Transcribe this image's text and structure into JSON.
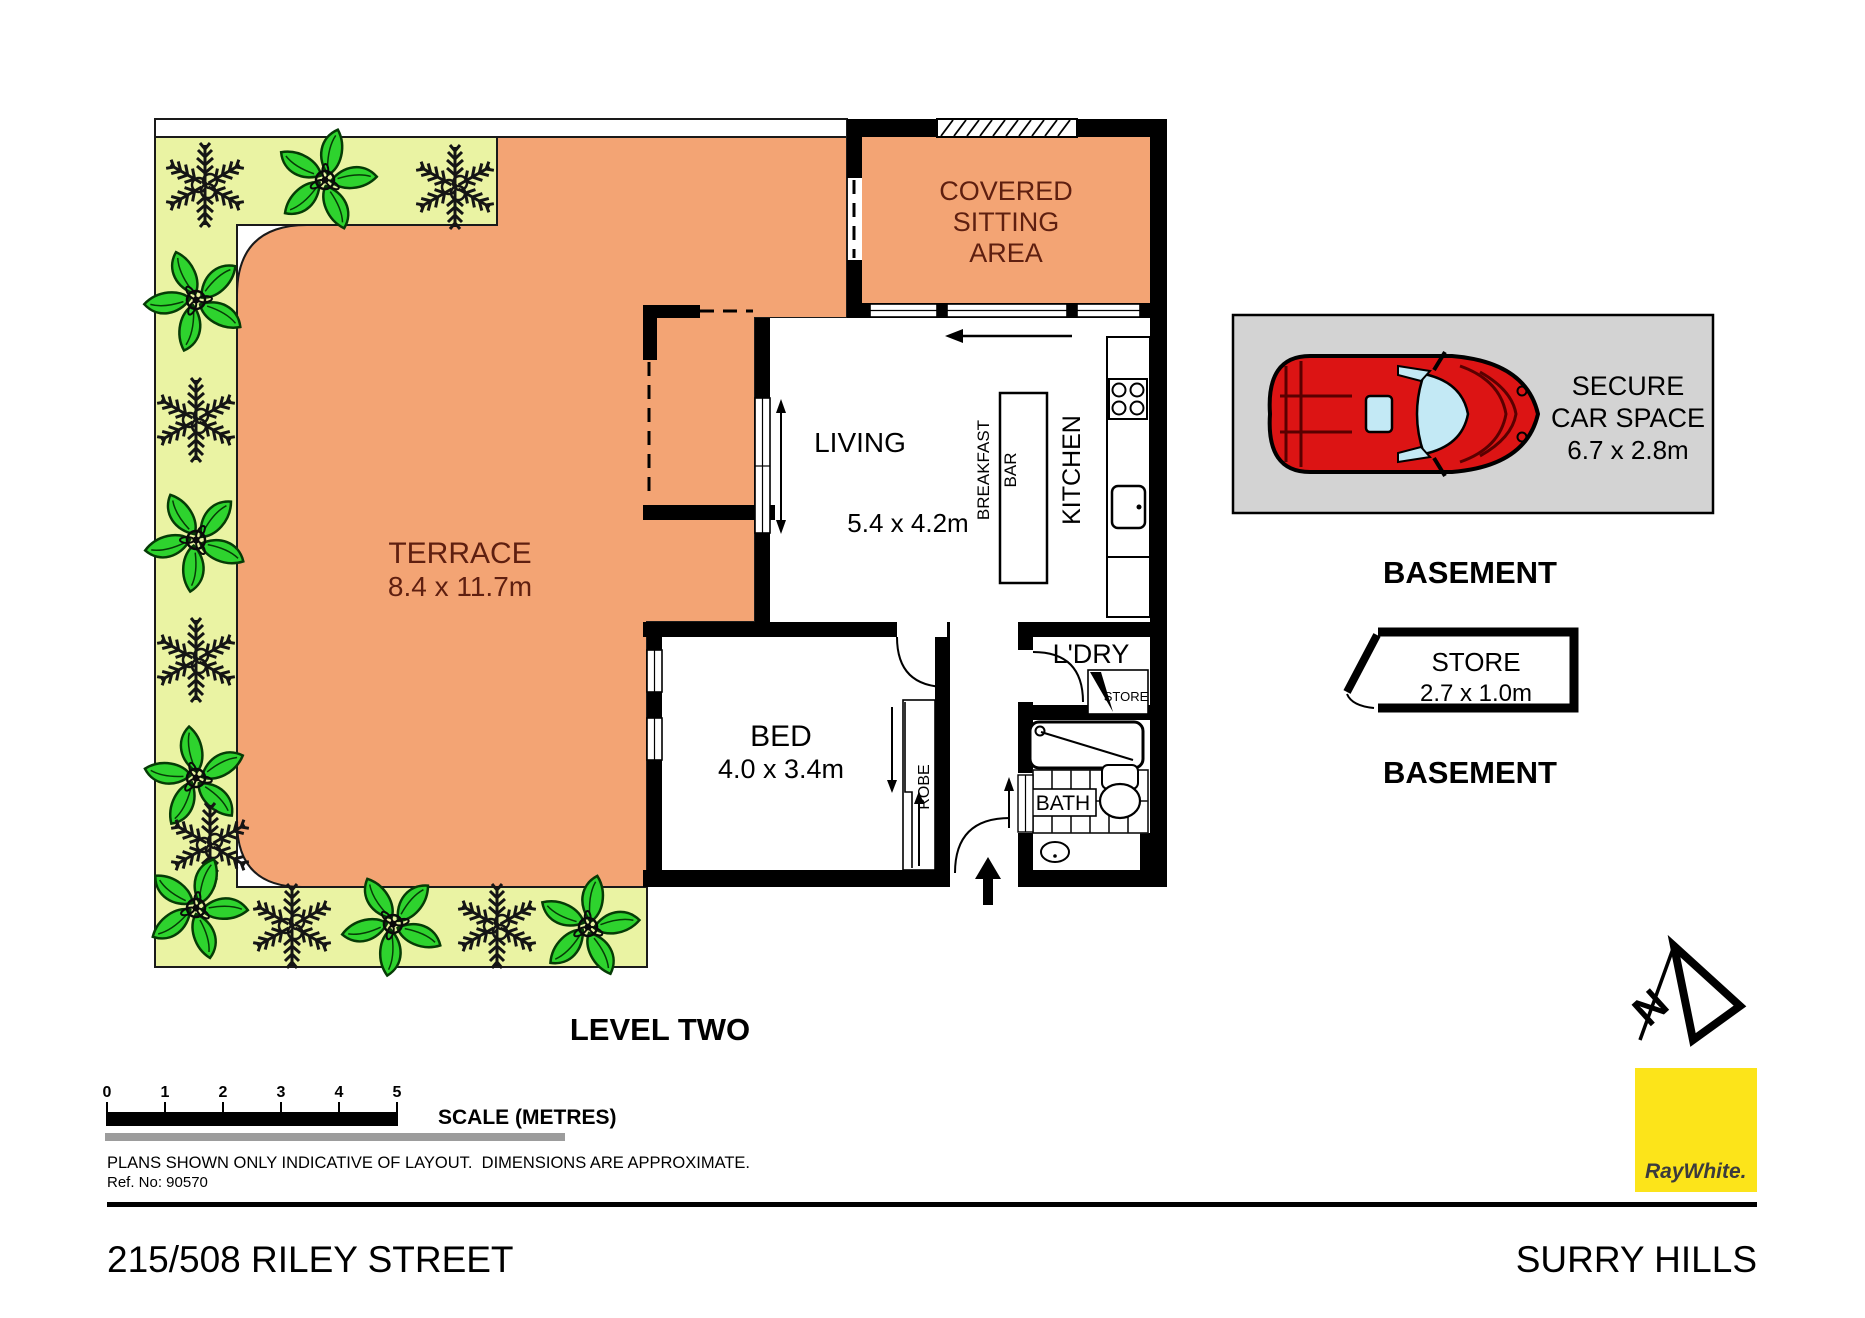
{
  "plan": {
    "level_label": "LEVEL TWO",
    "rooms": {
      "terrace": {
        "label": "TERRACE",
        "dims": "8.4 x 11.7m"
      },
      "covered_sitting": {
        "lines": [
          "COVERED",
          "SITTING",
          "AREA"
        ]
      },
      "living": {
        "label": "LIVING",
        "dims": "5.4 x 4.2m"
      },
      "kitchen": {
        "label": "KITCHEN"
      },
      "breakfast_bar": {
        "lines": [
          "BREAKFAST",
          "BAR"
        ]
      },
      "bed": {
        "label": "BED",
        "dims": "4.0 x 3.4m"
      },
      "robe": {
        "label": "ROBE"
      },
      "laundry": {
        "label": "L'DRY"
      },
      "store_nook": {
        "label": "STORE"
      },
      "bath": {
        "label": "BATH"
      }
    }
  },
  "basement": {
    "car_space": {
      "lines": [
        "SECURE",
        "CAR SPACE",
        "6.7 x 2.8m"
      ]
    },
    "label_1": "BASEMENT",
    "store": {
      "label": "STORE",
      "dims": "2.7 x 1.0m"
    },
    "label_2": "BASEMENT"
  },
  "scalebar": {
    "labels": [
      "0",
      "1",
      "2",
      "3",
      "4",
      "5"
    ],
    "caption": "SCALE (METRES)"
  },
  "notes": {
    "disclaimer": "PLANS SHOWN ONLY INDICATIVE OF LAYOUT.  DIMENSIONS ARE APPROXIMATE.",
    "ref": "Ref. No: 90570"
  },
  "footer": {
    "address": "215/508 RILEY STREET",
    "suburb": "SURRY HILLS"
  },
  "branding": {
    "logo_text": "RayWhite."
  },
  "colors": {
    "terrace_orange": "#F3A474",
    "garden_green": "#EAF3A3",
    "plant_green": "#2ED32E",
    "carspace_bg": "#D3D3D3",
    "car_red": "#DC1414",
    "car_window": "#C3E9F5",
    "brand_yellow": "#FCE41A",
    "room_text_dark_red": "#5E1F10",
    "scale_gray": "#9C9C9C"
  }
}
